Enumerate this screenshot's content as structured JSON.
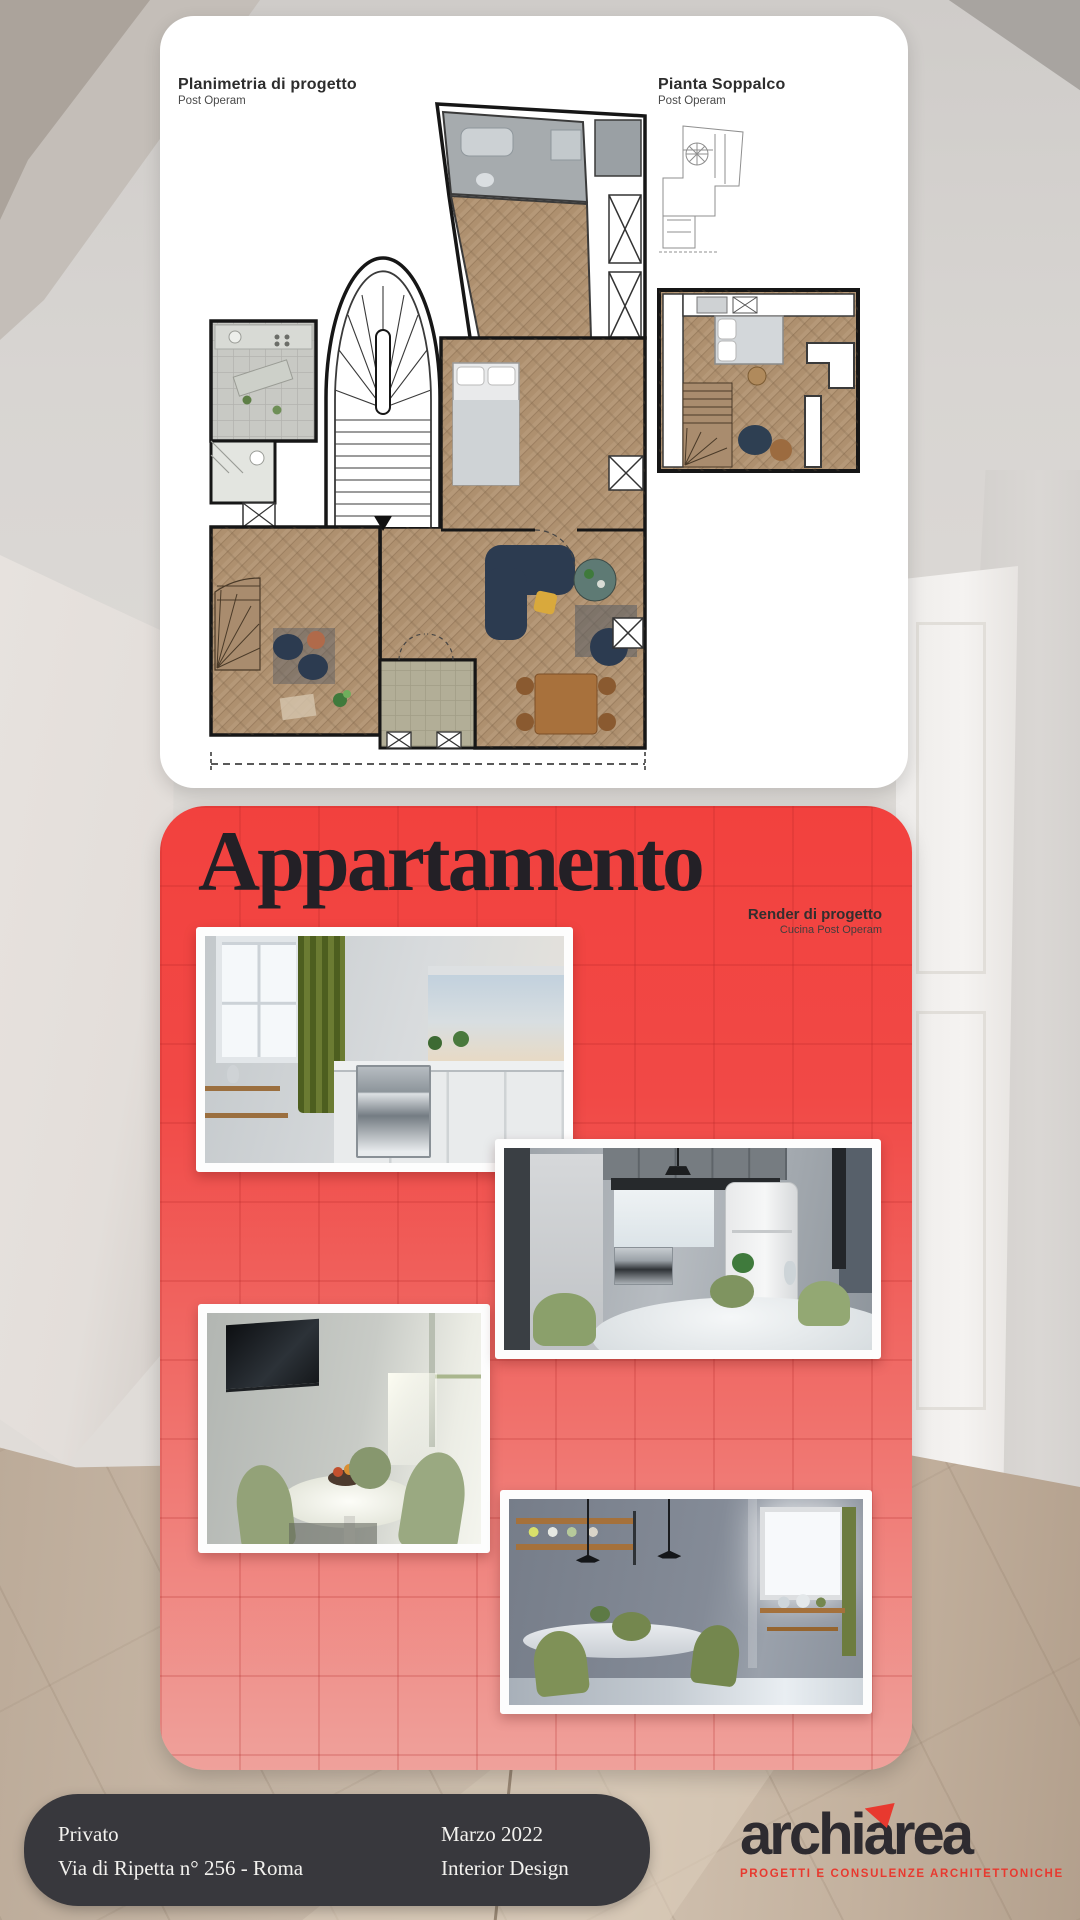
{
  "plans": {
    "main": {
      "title": "Planimetria di progetto",
      "subtitle": "Post Operam"
    },
    "soppalco": {
      "title": "Pianta Soppalco",
      "subtitle": "Post Operam"
    }
  },
  "project": {
    "title": "Appartamento",
    "render_title": "Render di progetto",
    "render_subtitle": "Cucina Post Operam",
    "card_color_top": "#f2413e",
    "card_color_bottom": "#efa19b"
  },
  "footer": {
    "client": "Privato",
    "address": "Via di Ripetta n° 256 - Roma",
    "date": "Marzo 2022",
    "category": "Interior Design"
  },
  "brand": {
    "logo_left": "archi",
    "logo_right": "area",
    "tagline": "PROGETTI E CONSULENZE ARCHITETTONICHE",
    "accent_color": "#e8392f"
  }
}
